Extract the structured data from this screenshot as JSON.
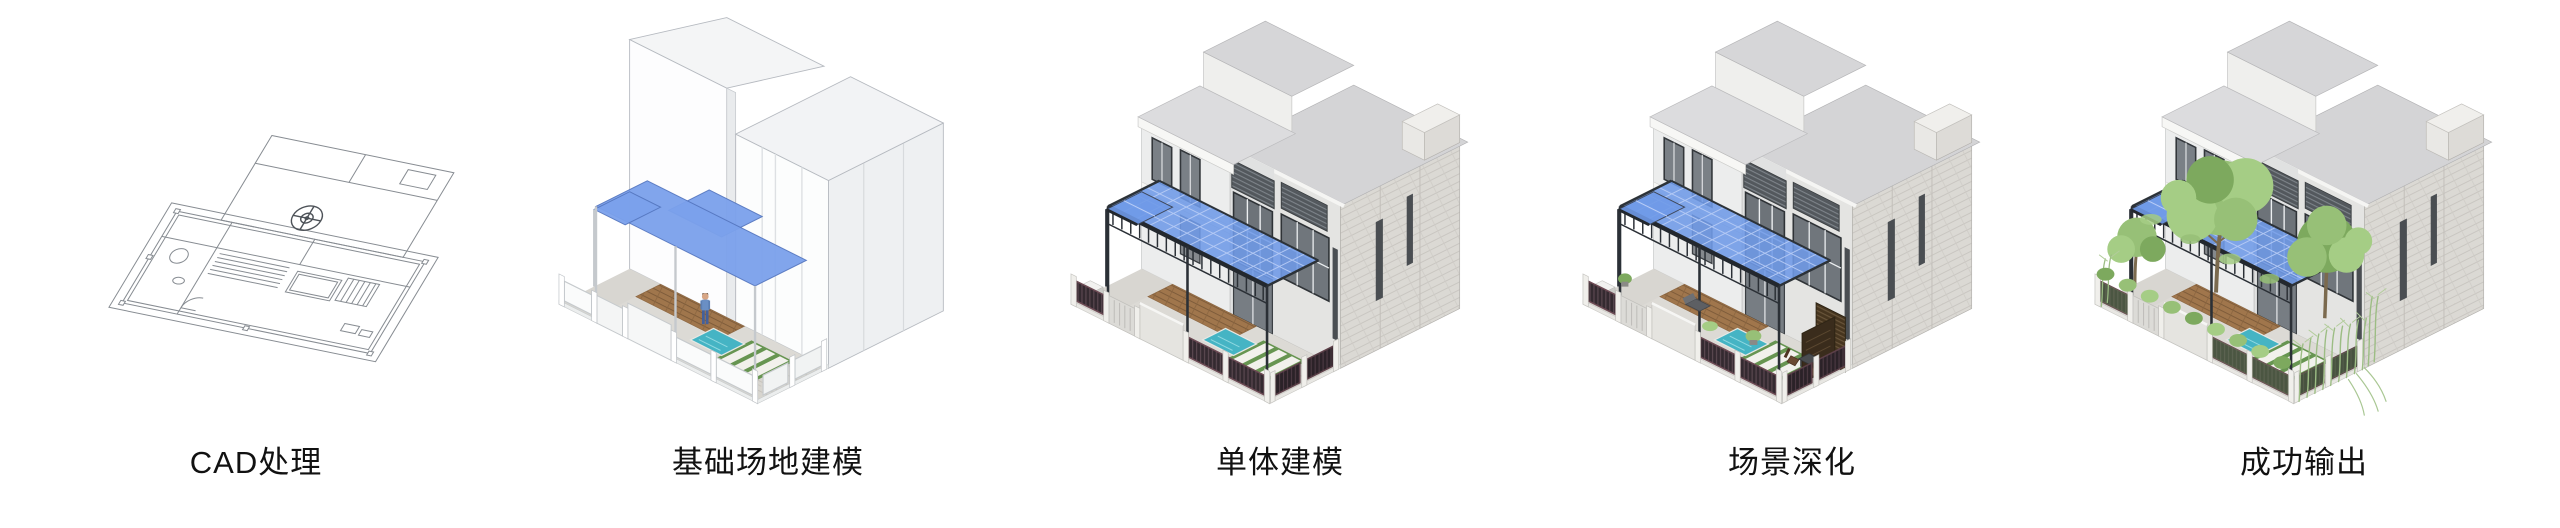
{
  "stages": [
    {
      "label": "CAD处理"
    },
    {
      "label": "基础场地建模"
    },
    {
      "label": "单体建模"
    },
    {
      "label": "场景深化"
    },
    {
      "label": "成功输出"
    }
  ],
  "colors": {
    "canopy_blue": "#7ba1ec",
    "glass_blue": "#6f9ae8",
    "pool_teal": "#45b4c4",
    "lawn_green": "#679551",
    "foliage_light": "#a5cd85",
    "foliage_mid": "#97c077",
    "foliage_dark": "#7da95e",
    "cad_line": "#878c92",
    "label_text": "#111111"
  }
}
